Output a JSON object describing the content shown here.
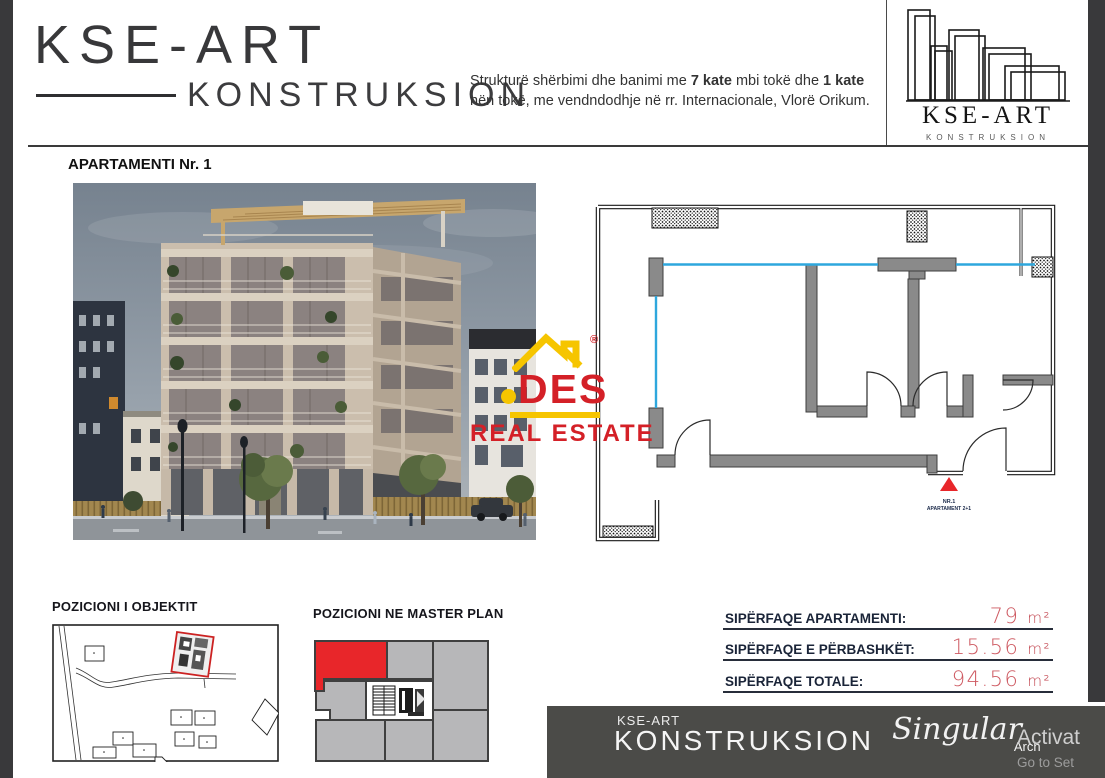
{
  "header": {
    "brand_title": "KSE-ART",
    "brand_subtitle": "KONSTRUKSION",
    "description": {
      "l1_a": "Strukturë shërbimi dhe banimi me ",
      "l1_b": "7 kate",
      "l1_c": " mbi tokë dhe ",
      "l1_d": "1 kate",
      "l2": "nën tokë, me vendndodhje në rr. Internacionale, Vlorë Orikum."
    },
    "logo_badge": {
      "title": "KSE-ART",
      "subtitle": "KONSTRUKSION"
    }
  },
  "section": {
    "title": "APARTAMENTI Nr. 1"
  },
  "floor_plan": {
    "marker": {
      "icon": "north-triangle-icon",
      "line1": "NR.1",
      "line2": "APARTAMENT 2+1"
    }
  },
  "watermark": {
    "icon": "house-roof-icon",
    "registered": "®",
    "brand": "DES",
    "subtitle": "REAL ESTATE"
  },
  "maps": {
    "site_plan_title": "POZICIONI I OBJEKTIT",
    "master_plan_title": "POZICIONI NE MASTER PLAN"
  },
  "areas": {
    "rows": [
      {
        "label": "SIPËRFAQE APARTAMENTI:",
        "value": "79",
        "unit": "m²"
      },
      {
        "label": "SIPËRFAQE E PËRBASHKËT:",
        "value": "15.56",
        "unit": "m²"
      },
      {
        "label": "SIPËRFAQE TOTALE:",
        "value": "94.56",
        "unit": "m²"
      }
    ]
  },
  "footer": {
    "brand_small": "KSE-ART",
    "brand_large": "KONSTRUKSION",
    "studio_name": "Singular",
    "studio_sub": "Arch",
    "activation_line1": "Activat",
    "activation_line2": "Go to Set"
  },
  "colors": {
    "accent_red": "#e8262a",
    "watermark_red": "#d42027",
    "watermark_yellow": "#f6c500",
    "glazing_blue": "#2ea7dd",
    "area_value_pink": "#ce5a62",
    "sidebar_dark": "#39393b",
    "footer_dark": "#4b4b48"
  }
}
